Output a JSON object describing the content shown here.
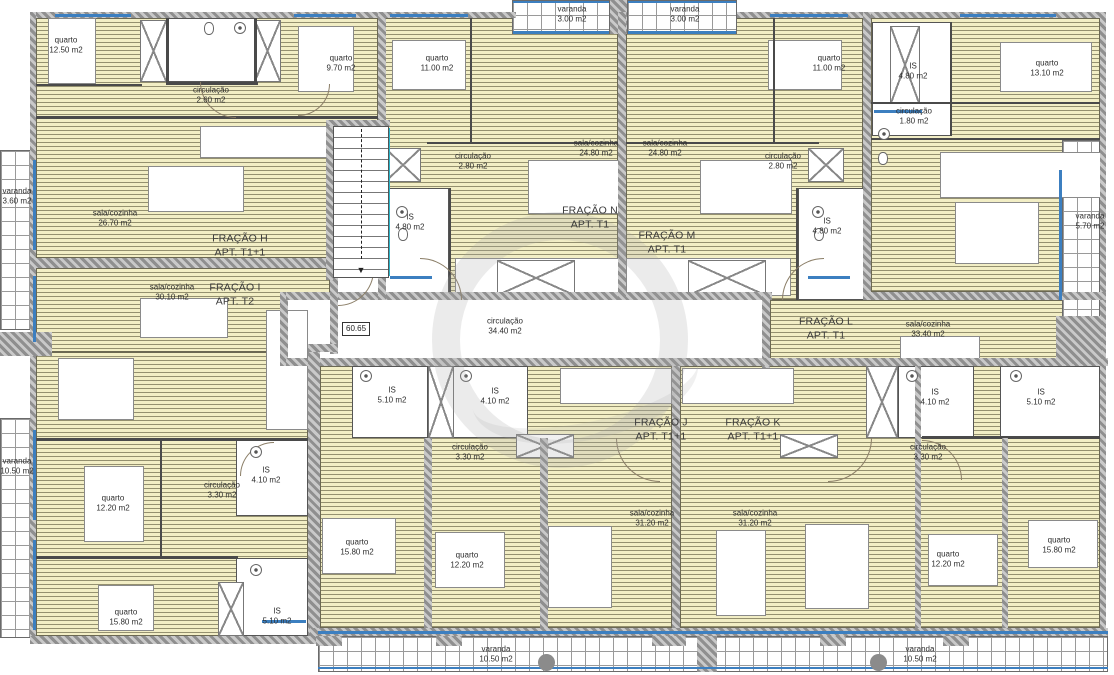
{
  "title": "floor-plan",
  "scale_label": "60.65",
  "colors": {
    "floor_stripe": "#f2eec5",
    "floor_line": "#94906f",
    "wall_hatch": "#9a9a9a",
    "partition": "#4a4a4a",
    "window_blue": "#3c7fc0",
    "stair_edge_teal": "#2ab5c9",
    "text": "#2e2e2e"
  },
  "fractions": [
    {
      "name": "FRAÇÃO H",
      "type": "APT. T1+1"
    },
    {
      "name": "FRAÇÃO I",
      "type": "APT. T2"
    },
    {
      "name": "FRAÇÃO J",
      "type": "APT. T1+1"
    },
    {
      "name": "FRAÇÃO K",
      "type": "APT. T1+1"
    },
    {
      "name": "FRAÇÃO L",
      "type": "APT. T1"
    },
    {
      "name": "FRAÇÃO M",
      "type": "APT. T1"
    },
    {
      "name": "FRAÇÃO N",
      "type": "APT. T1"
    }
  ],
  "labels": [
    {
      "l1": "quarto",
      "l2": "12.50 m2",
      "x": 66,
      "y": 46
    },
    {
      "l1": "varanda",
      "l2": "3.00 m2",
      "x": 572,
      "y": 15
    },
    {
      "l1": "varanda",
      "l2": "3.00 m2",
      "x": 685,
      "y": 15
    },
    {
      "l1": "quarto",
      "l2": "9.70 m2",
      "x": 341,
      "y": 64
    },
    {
      "l1": "quarto",
      "l2": "11.00 m2",
      "x": 437,
      "y": 64
    },
    {
      "l1": "quarto",
      "l2": "11.00 m2",
      "x": 829,
      "y": 64
    },
    {
      "l1": "IS",
      "l2": "4.80 m2",
      "x": 913,
      "y": 72
    },
    {
      "l1": "quarto",
      "l2": "13.10 m2",
      "x": 1047,
      "y": 69
    },
    {
      "l1": "circulação",
      "l2": "2.60 m2",
      "x": 211,
      "y": 96
    },
    {
      "l1": "circulação",
      "l2": "1.80 m2",
      "x": 914,
      "y": 117
    },
    {
      "l1": "sala/cozinha",
      "l2": "24.80 m2",
      "x": 596,
      "y": 149
    },
    {
      "l1": "sala/cozinha",
      "l2": "24.80 m2",
      "x": 665,
      "y": 149
    },
    {
      "l1": "circulação",
      "l2": "2.80 m2",
      "x": 473,
      "y": 162
    },
    {
      "l1": "circulação",
      "l2": "2.80 m2",
      "x": 783,
      "y": 162
    },
    {
      "l1": "varanda",
      "l2": "3.60 m2",
      "x": 17,
      "y": 197
    },
    {
      "l1": "sala/cozinha",
      "l2": "26.70 m2",
      "x": 115,
      "y": 219
    },
    {
      "l1": "varanda",
      "l2": "5.70 m2",
      "x": 1090,
      "y": 222
    },
    {
      "l1": "IS",
      "l2": "4.80 m2",
      "x": 410,
      "y": 223
    },
    {
      "l1": "IS",
      "l2": "4.80 m2",
      "x": 827,
      "y": 227
    },
    {
      "l1": "FRAÇÃO N",
      "l2": "APT. T1",
      "x": 590,
      "y": 218,
      "f": 1
    },
    {
      "l1": "FRAÇÃO M",
      "l2": "APT. T1",
      "x": 667,
      "y": 243,
      "f": 1
    },
    {
      "l1": "FRAÇÃO H",
      "l2": "APT. T1+1",
      "x": 240,
      "y": 246,
      "f": 1
    },
    {
      "l1": "FRAÇÃO I",
      "l2": "APT. T2",
      "x": 235,
      "y": 295,
      "f": 1
    },
    {
      "l1": "sala/cozinha",
      "l2": "30.10 m2",
      "x": 172,
      "y": 293
    },
    {
      "l1": "circulação",
      "l2": "34.40 m2",
      "x": 505,
      "y": 327
    },
    {
      "l1": "FRAÇÃO L",
      "l2": "APT. T1",
      "x": 826,
      "y": 329,
      "f": 1
    },
    {
      "l1": "sala/cozinha",
      "l2": "33.40 m2",
      "x": 928,
      "y": 330
    },
    {
      "l1": "IS",
      "l2": "5.10 m2",
      "x": 392,
      "y": 396
    },
    {
      "l1": "IS",
      "l2": "4.10 m2",
      "x": 495,
      "y": 397
    },
    {
      "l1": "IS",
      "l2": "4.10 m2",
      "x": 935,
      "y": 398
    },
    {
      "l1": "IS",
      "l2": "5.10 m2",
      "x": 1041,
      "y": 398
    },
    {
      "l1": "FRAÇÃO J",
      "l2": "APT. T1+1",
      "x": 661,
      "y": 430,
      "f": 1
    },
    {
      "l1": "FRAÇÃO K",
      "l2": "APT. T1+1",
      "x": 753,
      "y": 430,
      "f": 1
    },
    {
      "l1": "circulação",
      "l2": "3.30 m2",
      "x": 470,
      "y": 453
    },
    {
      "l1": "circulação",
      "l2": "3.30 m2",
      "x": 928,
      "y": 453
    },
    {
      "l1": "varanda",
      "l2": "10.50 m2",
      "x": 17,
      "y": 467
    },
    {
      "l1": "IS",
      "l2": "4.10 m2",
      "x": 266,
      "y": 476
    },
    {
      "l1": "circulação",
      "l2": "3.30 m2",
      "x": 222,
      "y": 491
    },
    {
      "l1": "quarto",
      "l2": "12.20 m2",
      "x": 113,
      "y": 504
    },
    {
      "l1": "sala/cozinha",
      "l2": "31.20 m2",
      "x": 652,
      "y": 519
    },
    {
      "l1": "sala/cozinha",
      "l2": "31.20 m2",
      "x": 755,
      "y": 519
    },
    {
      "l1": "quarto",
      "l2": "15.80 m2",
      "x": 357,
      "y": 548
    },
    {
      "l1": "quarto",
      "l2": "12.20 m2",
      "x": 467,
      "y": 561
    },
    {
      "l1": "quarto",
      "l2": "12.20 m2",
      "x": 948,
      "y": 560
    },
    {
      "l1": "quarto",
      "l2": "15.80 m2",
      "x": 1059,
      "y": 546
    },
    {
      "l1": "quarto",
      "l2": "15.80 m2",
      "x": 126,
      "y": 618
    },
    {
      "l1": "IS",
      "l2": "5.10 m2",
      "x": 277,
      "y": 617
    },
    {
      "l1": "varanda",
      "l2": "10.50 m2",
      "x": 496,
      "y": 655
    },
    {
      "l1": "varanda",
      "l2": "10.50 m2",
      "x": 920,
      "y": 655
    }
  ]
}
